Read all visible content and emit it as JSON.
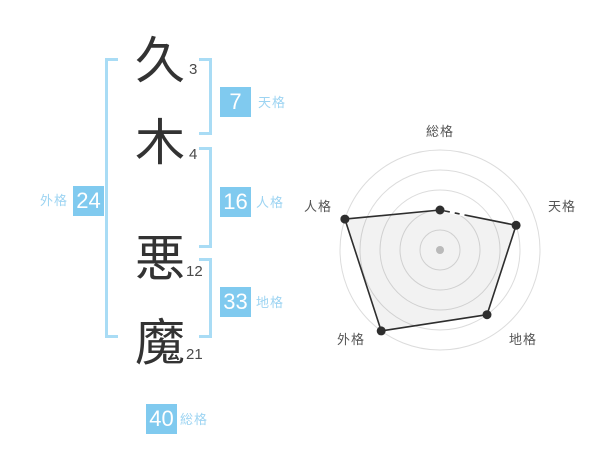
{
  "name_display": {
    "surname": "久木",
    "given_name": "悪魔",
    "characters": [
      {
        "char": "久",
        "strokes": "3"
      },
      {
        "char": "木",
        "strokes": "4"
      },
      {
        "char": "悪",
        "strokes": "12"
      },
      {
        "char": "魔",
        "strokes": "21"
      }
    ]
  },
  "categories": [
    {
      "id": "tenkaku",
      "label": "天格",
      "value": "7"
    },
    {
      "id": "jinkaku",
      "label": "人格",
      "value": "16"
    },
    {
      "id": "chikaku",
      "label": "地格",
      "value": "33"
    },
    {
      "id": "gaikaku",
      "label": "外格",
      "value": "24"
    },
    {
      "id": "soukaku",
      "label": "総格",
      "value": "40"
    }
  ],
  "colors": {
    "badge_bg": "#80caef",
    "badge_text": "#ffffff",
    "category_label_blue": "#9dd4f2",
    "bracket_blue": "#a9dcf5",
    "kanji_text": "#333333",
    "stroke_count_text": "#4a4a4a",
    "chart_grid": "#dcdcdc",
    "chart_line": "#2e2e2e",
    "chart_fill": "rgba(0,0,0,0.05)",
    "chart_label": "#555555",
    "chart_center_dot": "#c4c4c4"
  },
  "chart_data": {
    "type": "radar",
    "axes": [
      "総格",
      "天格",
      "地格",
      "外格",
      "人格"
    ],
    "values": [
      2,
      4,
      4,
      5,
      5
    ],
    "max": 5,
    "rings": 5,
    "start_angle_deg": -90,
    "direction": "clockwise",
    "grid": "concentric-circles",
    "legend": "none",
    "title": ""
  }
}
